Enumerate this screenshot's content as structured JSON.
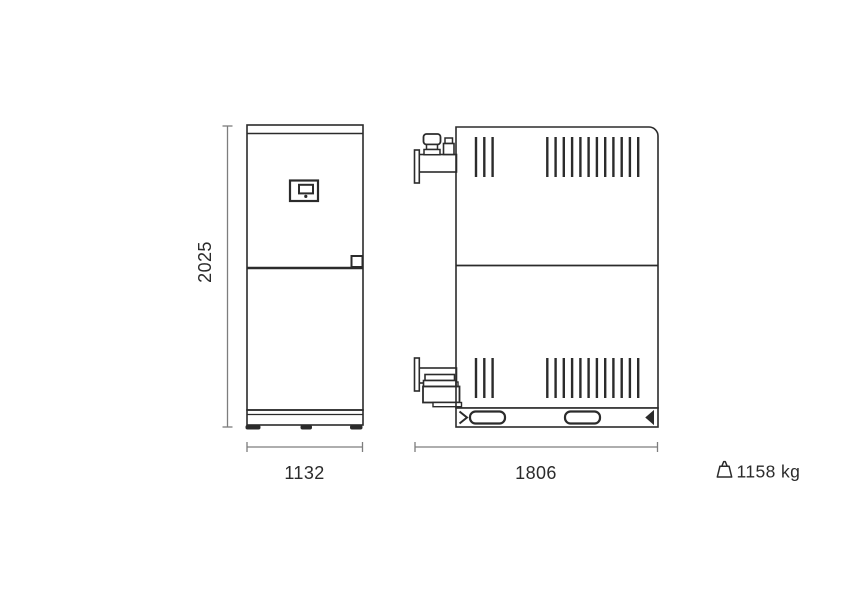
{
  "front_view": {
    "height_label": "2025",
    "width_label": "1132"
  },
  "side_view": {
    "width_label": "1806"
  },
  "weight": {
    "icon": "weight-icon",
    "label": "1158 kg"
  },
  "colors": {
    "outline": "#2b2b2b",
    "dimension_lines": "#7d7d7d",
    "label_text": "#2b2b2b",
    "background": "#ffffff"
  }
}
